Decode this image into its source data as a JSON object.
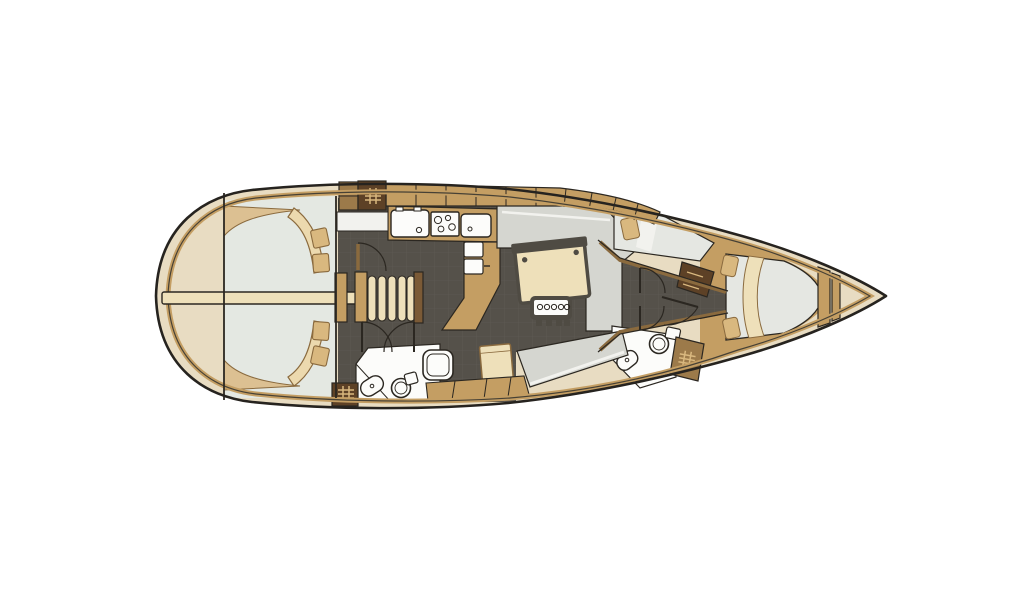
{
  "meta": {
    "title": "Sailing yacht interior floor plan (top view)",
    "diagram_type": "boat-floor-plan",
    "orientation": {
      "bow": "right",
      "stern": "left"
    }
  },
  "canvas": {
    "width": 1024,
    "height": 600,
    "background": "#ffffff"
  },
  "colors": {
    "bg": "#ffffff",
    "hull_fill": "#e8dcc2",
    "line": "#2b2721",
    "wood": "#c49e63",
    "wood_light": "#dcc092",
    "wood_deep": "#5d4126",
    "wood_mid": "#9c7a4a",
    "wood_edge": "#8a6a3e",
    "floor_dark": "#55514a",
    "floor_grid": "#6a665d",
    "cockpit_light": "#e4e8e2",
    "cabin_light": "#e2e5df",
    "settee_gray": "#d5d6d0",
    "berth_light": "#e5e7e2",
    "white_fixture": "#fcfcfa",
    "cream_obj": "#eee0ba",
    "crescent": "#ecd9ae",
    "pillow": "#d9b87f",
    "panel_dark": "#4f4b43",
    "highlight": "#f2f2ee",
    "hash_line": "#d9b87f"
  },
  "parts": {
    "stern_section": [
      "swim-platform",
      "cockpit",
      "cockpit-table",
      "cockpit-bench-port",
      "cockpit-bench-starboard",
      "winch-pad",
      "companionway-steps"
    ],
    "salon_section": [
      "galley-cabinets",
      "galley-sink",
      "galley-stove",
      "galley-second-sink",
      "fridge-boxes",
      "salon-table",
      "u-settee",
      "instrument-panel",
      "chart-table",
      "side-bench"
    ],
    "cabin_section": [
      "mid-cabin-berth",
      "forward-v-berth",
      "berth-pillow",
      "hanging-locker",
      "shelf-locker"
    ],
    "heads_section": [
      "aft-heads",
      "aft-toilet",
      "aft-sink",
      "shower-tray",
      "forward-heads",
      "forward-toilet",
      "forward-sink"
    ],
    "bow_section": [
      "collision-bulkhead",
      "anchor-locker"
    ]
  }
}
